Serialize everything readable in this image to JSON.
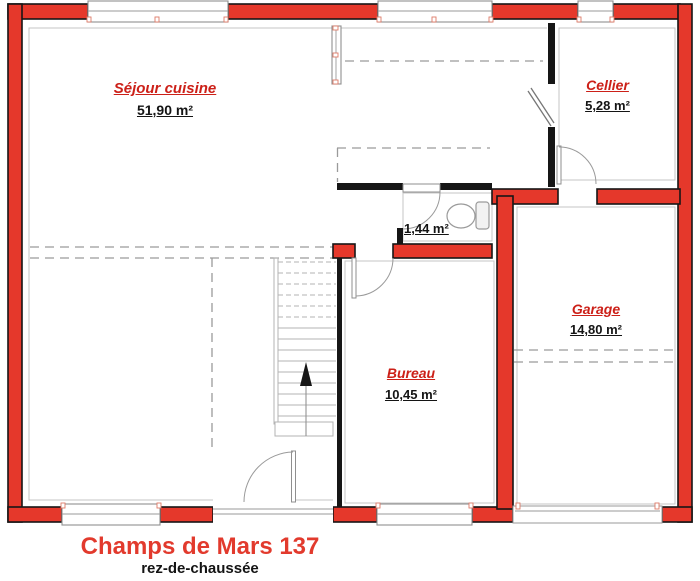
{
  "plan": {
    "title": "Champs de Mars 137",
    "subtitle": "rez-de-chaussée",
    "rooms": {
      "sejour": {
        "name": "Séjour cuisine",
        "area": "51,90 m²"
      },
      "cellier": {
        "name": "Cellier",
        "area": "5,28 m²"
      },
      "wc": {
        "area": "1,44 m²"
      },
      "garage": {
        "name": "Garage",
        "area": "14,80 m²"
      },
      "bureau": {
        "name": "Bureau",
        "area": "10,45 m²"
      }
    },
    "colors": {
      "wall_red": "#e5382b",
      "wall_black": "#161616",
      "label_red": "#cc2018",
      "thin_line_gray": "#9a9a9a"
    }
  }
}
